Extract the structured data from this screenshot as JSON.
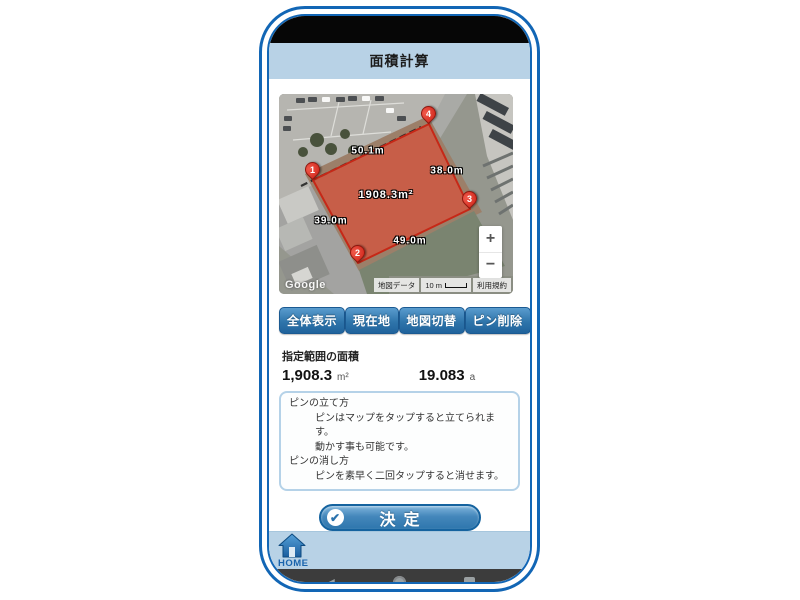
{
  "app": {
    "title": "面積計算"
  },
  "map": {
    "pins": [
      {
        "number": "1"
      },
      {
        "number": "2"
      },
      {
        "number": "3"
      },
      {
        "number": "4"
      }
    ],
    "measurements": {
      "edge_1_4": "50.1m",
      "edge_4_3": "38.0m",
      "edge_1_2": "39.0m",
      "edge_2_3": "49.0m",
      "area": "1908.3m²"
    },
    "controls": {
      "zoom_in": "+",
      "zoom_out": "−"
    },
    "google_logo": "Google",
    "attribution": {
      "map_data": "地図データ",
      "scale": "10 m",
      "terms": "利用規約"
    }
  },
  "toolbar": {
    "buttons": [
      {
        "label": "全体表示"
      },
      {
        "label": "現在地"
      },
      {
        "label": "地図切替"
      },
      {
        "label": "ピン削除"
      }
    ]
  },
  "result": {
    "caption": "指定範囲の面積",
    "sqm_value": "1,908.3",
    "sqm_unit": "m²",
    "are_value": "19.083",
    "are_unit": "a"
  },
  "help": {
    "lines": [
      {
        "text": "ピンの立て方"
      },
      {
        "text": "ピンはマップをタップすると立てられます。"
      },
      {
        "text": "動かす事も可能です。"
      },
      {
        "text": "ピンの消し方"
      },
      {
        "text": "ピンを素早く二回タップすると消せます。"
      }
    ]
  },
  "decide_button": {
    "label": "決定",
    "check": "✔"
  },
  "footer": {
    "home": "HOME"
  },
  "nav": {
    "back_glyph": "◀"
  },
  "colors": {
    "accent_blue": "#2a72ad",
    "frame_blue": "#1266b5",
    "header_bg": "#b8d2e6",
    "pin_red": "#d32a1c",
    "polygon_fill": "rgba(226,74,51,0.62)",
    "polygon_stroke": "#c62817"
  }
}
